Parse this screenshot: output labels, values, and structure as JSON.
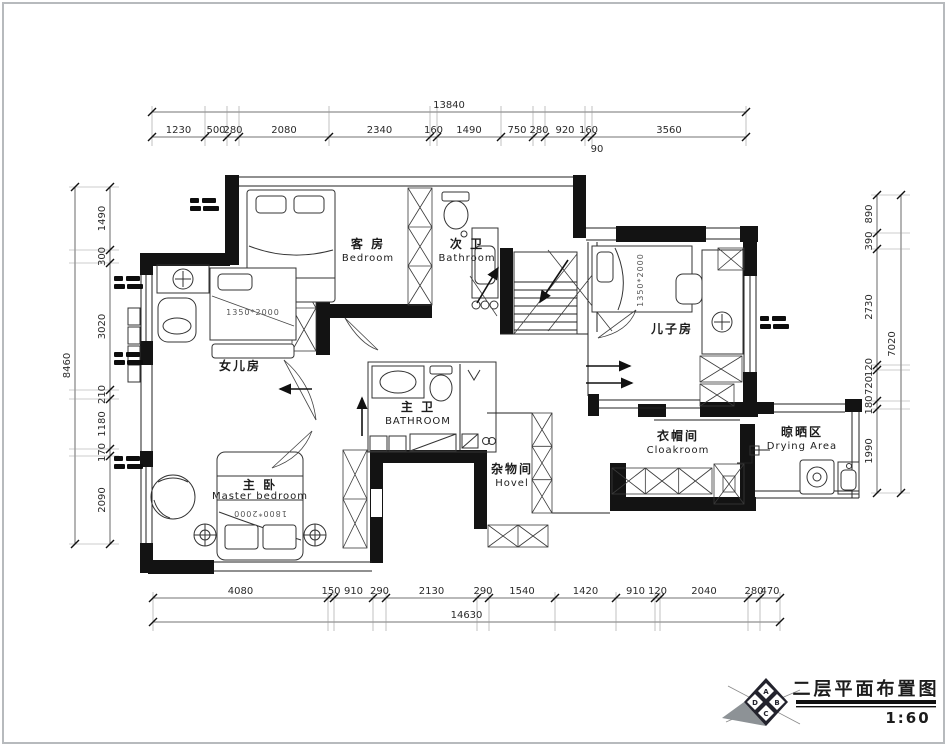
{
  "drawing": {
    "title": "二层平面布置图",
    "scale": "1:60",
    "logo_letters": [
      "A",
      "B",
      "C",
      "D"
    ]
  },
  "dimensions": {
    "top": {
      "total": "13840",
      "extra": "90",
      "segments": [
        "1230",
        "500",
        "280",
        "2080",
        "2340",
        "160",
        "1490",
        "750",
        "280",
        "920",
        "160",
        "3560"
      ]
    },
    "bottom": {
      "total": "14630",
      "segments": [
        "4080",
        "150",
        "910",
        "290",
        "2130",
        "290",
        "1540",
        "1420",
        "910",
        "120",
        "2040",
        "280",
        "470"
      ]
    },
    "left": {
      "total": "8460",
      "segments": [
        "1490",
        "300",
        "3020",
        "210",
        "1180",
        "170",
        "2090"
      ]
    },
    "right": {
      "total": "7020",
      "segments": [
        "890",
        "390",
        "2730",
        "120",
        "720",
        "180",
        "1990"
      ]
    }
  },
  "rooms": {
    "guest_bedroom": {
      "cn": "客 房",
      "en": "Bedroom"
    },
    "guest_bath": {
      "cn": "次 卫",
      "en": "Bathroom"
    },
    "daughter_room": {
      "cn": "女儿房",
      "en": ""
    },
    "son_room": {
      "cn": "儿子房",
      "en": ""
    },
    "master_bath": {
      "cn": "主 卫",
      "en": "BATHROOM"
    },
    "master_bedroom": {
      "cn": "主 卧",
      "en": "Master bedroom"
    },
    "storage": {
      "cn": "杂物间",
      "en": "Hovel"
    },
    "cloakroom": {
      "cn": "衣帽间",
      "en": "Cloakroom"
    },
    "drying": {
      "cn": "晾晒区",
      "en": "Drying Area"
    }
  },
  "furniture": {
    "daughter_bed_size": "1350*2000",
    "son_bed_size": "1350*2000",
    "master_bed_size": "1800*2000"
  }
}
